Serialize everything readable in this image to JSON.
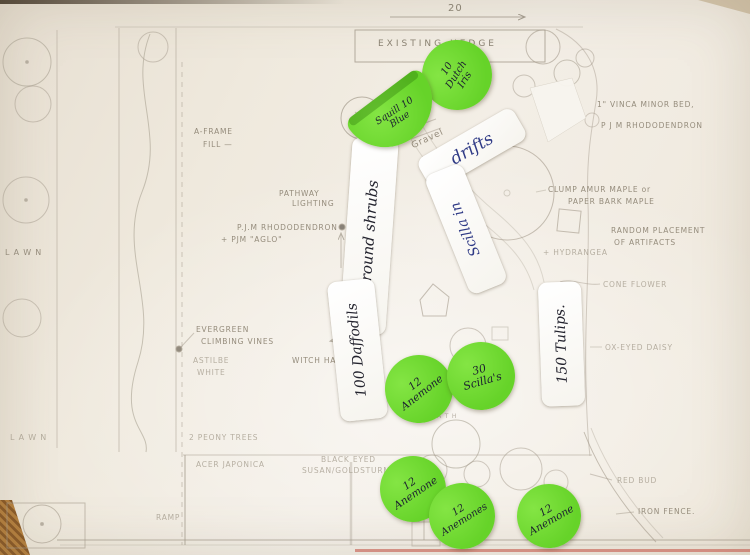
{
  "colors": {
    "sticker_green": "#66d329",
    "ink_blue": "#2f3a86",
    "ink_black": "#23232e",
    "pencil": "#958c7c",
    "mat": "#c9b697"
  },
  "hedge": {
    "label": "EXISTING HEDGE"
  },
  "dimensions": {
    "top": "20",
    "left": "49'"
  },
  "pencil_notes": [
    {
      "id": "a-frame",
      "text": "A-FRAME",
      "x": 194,
      "y": 127,
      "rot": 0
    },
    {
      "id": "a-frame-fill",
      "text": "FILL —",
      "x": 203,
      "y": 140,
      "rot": 0
    },
    {
      "id": "pathway",
      "text": "PATHWAY",
      "x": 279,
      "y": 189,
      "rot": 0
    },
    {
      "id": "lighting",
      "text": "LIGHTING",
      "x": 292,
      "y": 199,
      "rot": 0
    },
    {
      "id": "pjm-rhododendron-left",
      "text": "P.J.M RHODODENDRON",
      "x": 237,
      "y": 223,
      "rot": 0
    },
    {
      "id": "pjm-aglo",
      "text": "+ PJM \"AGLO\"",
      "x": 221,
      "y": 235,
      "rot": 0
    },
    {
      "id": "lawn-upper",
      "text": "L A W N",
      "x": 5,
      "y": 248,
      "size": 8
    },
    {
      "id": "evergreen",
      "text": "EVERGREEN",
      "x": 196,
      "y": 325,
      "rot": 0
    },
    {
      "id": "climbing-vines",
      "text": "CLIMBING VINES",
      "x": 201,
      "y": 337,
      "rot": 0
    },
    {
      "id": "astilbe",
      "text": "ASTILBE",
      "x": 193,
      "y": 356,
      "faint": true
    },
    {
      "id": "astilbe-white",
      "text": "WHITE",
      "x": 197,
      "y": 368,
      "faint": true
    },
    {
      "id": "witch-hazel",
      "text": "WITCH HAZEL",
      "x": 292,
      "y": 356,
      "rot": 0
    },
    {
      "id": "gravel",
      "text": "Gravel",
      "x": 410,
      "y": 142,
      "rot": -25,
      "size": 9
    },
    {
      "id": "peony-trees",
      "text": "2 PEONY TREES",
      "x": 189,
      "y": 433,
      "faint": true
    },
    {
      "id": "acer-japonica",
      "text": "ACER JAPONICA",
      "x": 196,
      "y": 460,
      "faint": true
    },
    {
      "id": "black-eyed",
      "text": "BLACK EYED",
      "x": 321,
      "y": 455,
      "faint": true
    },
    {
      "id": "susan-goldsturm",
      "text": "SUSAN/GOLDSTURM",
      "x": 302,
      "y": 466,
      "faint": true
    },
    {
      "id": "lawn-lower",
      "text": "L A W N",
      "x": 10,
      "y": 433,
      "size": 8,
      "faint": true
    },
    {
      "id": "ramp",
      "text": "RAMP",
      "x": 156,
      "y": 513,
      "faint": true
    },
    {
      "id": "path",
      "text": "P A T H",
      "x": 430,
      "y": 413,
      "size": 6,
      "faint": true
    },
    {
      "id": "vinca",
      "text": "1\" VINCA MINOR BED,",
      "x": 597,
      "y": 100,
      "rot": 0
    },
    {
      "id": "pjm-rhododendron-right",
      "text": "P J M RHODODENDRON",
      "x": 601,
      "y": 121,
      "rot": 0
    },
    {
      "id": "clump-amur",
      "text": "CLUMP AMUR MAPLE or",
      "x": 548,
      "y": 185,
      "rot": 0
    },
    {
      "id": "paper-bark",
      "text": "PAPER BARK MAPLE",
      "x": 568,
      "y": 197,
      "rot": 0
    },
    {
      "id": "random-placement",
      "text": "RANDOM PLACEMENT",
      "x": 611,
      "y": 226,
      "rot": 0
    },
    {
      "id": "of-artifacts",
      "text": "OF ARTIFACTS",
      "x": 614,
      "y": 238,
      "rot": 0
    },
    {
      "id": "hydrangea",
      "text": "+ HYDRANGEA",
      "x": 543,
      "y": 248,
      "faint": true
    },
    {
      "id": "cone-flower",
      "text": "CONE FLOWER",
      "x": 603,
      "y": 280,
      "faint": true
    },
    {
      "id": "ox-eyed-daisy",
      "text": "OX-EYED DAISY",
      "x": 605,
      "y": 343,
      "faint": true
    },
    {
      "id": "red-bud",
      "text": "RED BUD",
      "x": 617,
      "y": 476,
      "faint": true
    },
    {
      "id": "iron-fence",
      "text": "IRON FENCE.",
      "x": 638,
      "y": 507,
      "rot": 0
    }
  ],
  "white_labels": [
    {
      "id": "around-shrubs",
      "text": "Around shrubs",
      "ink": "black",
      "cx": 369,
      "cy": 236,
      "w": 46,
      "h": 196,
      "rot": 4,
      "vertical": true,
      "size": 15
    },
    {
      "id": "drifts",
      "text": "drifts",
      "ink": "blue",
      "cx": 472,
      "cy": 149,
      "w": 110,
      "h": 36,
      "rot": -30,
      "vertical": false,
      "size": 17
    },
    {
      "id": "scilla-in",
      "text": "Scilla in",
      "ink": "blue",
      "cx": 466,
      "cy": 229,
      "w": 40,
      "h": 128,
      "rot": -22,
      "vertical": true,
      "size": 14
    },
    {
      "id": "daffodils-100",
      "text": "100 Daffodils",
      "ink": "black",
      "cx": 357,
      "cy": 350,
      "w": 47,
      "h": 140,
      "rot": -6,
      "vertical": true,
      "size": 14
    },
    {
      "id": "tulips-150",
      "text": "150 Tulips.",
      "ink": "black",
      "cx": 561,
      "cy": 344,
      "w": 43,
      "h": 124,
      "rot": -2,
      "vertical": true,
      "size": 14
    }
  ],
  "green_stickers": [
    {
      "id": "dutch-iris-10",
      "lines": [
        "10",
        "Dutch",
        "Iris"
      ],
      "cx": 457,
      "cy": 75,
      "r": 35,
      "rot": -58,
      "size": 10
    },
    {
      "id": "blue-squill-10",
      "lines": [
        "Squill 10",
        "Blue"
      ],
      "cx": 397,
      "cy": 116,
      "w": 92,
      "h": 54,
      "rot": -37,
      "size": 9.5,
      "folded": true
    },
    {
      "id": "anemone-12-mid",
      "lines": [
        "12",
        "Anemone"
      ],
      "cx": 419,
      "cy": 389,
      "r": 34,
      "rot": -38,
      "size": 10.5
    },
    {
      "id": "scilla-30",
      "lines": [
        "30",
        "Scilla's"
      ],
      "cx": 481,
      "cy": 376,
      "r": 34,
      "rot": -16,
      "size": 11
    },
    {
      "id": "anemone-12-b1",
      "lines": [
        "12",
        "Anemone"
      ],
      "cx": 413,
      "cy": 489,
      "r": 33,
      "rot": -34,
      "size": 10.5
    },
    {
      "id": "anemone-12-b2",
      "lines": [
        "12",
        "Anemones"
      ],
      "cx": 462,
      "cy": 516,
      "r": 33,
      "rot": -32,
      "size": 10
    },
    {
      "id": "anemone-12-b3",
      "lines": [
        "12",
        "Anemone"
      ],
      "cx": 549,
      "cy": 516,
      "r": 32,
      "rot": -30,
      "size": 10.5
    }
  ]
}
